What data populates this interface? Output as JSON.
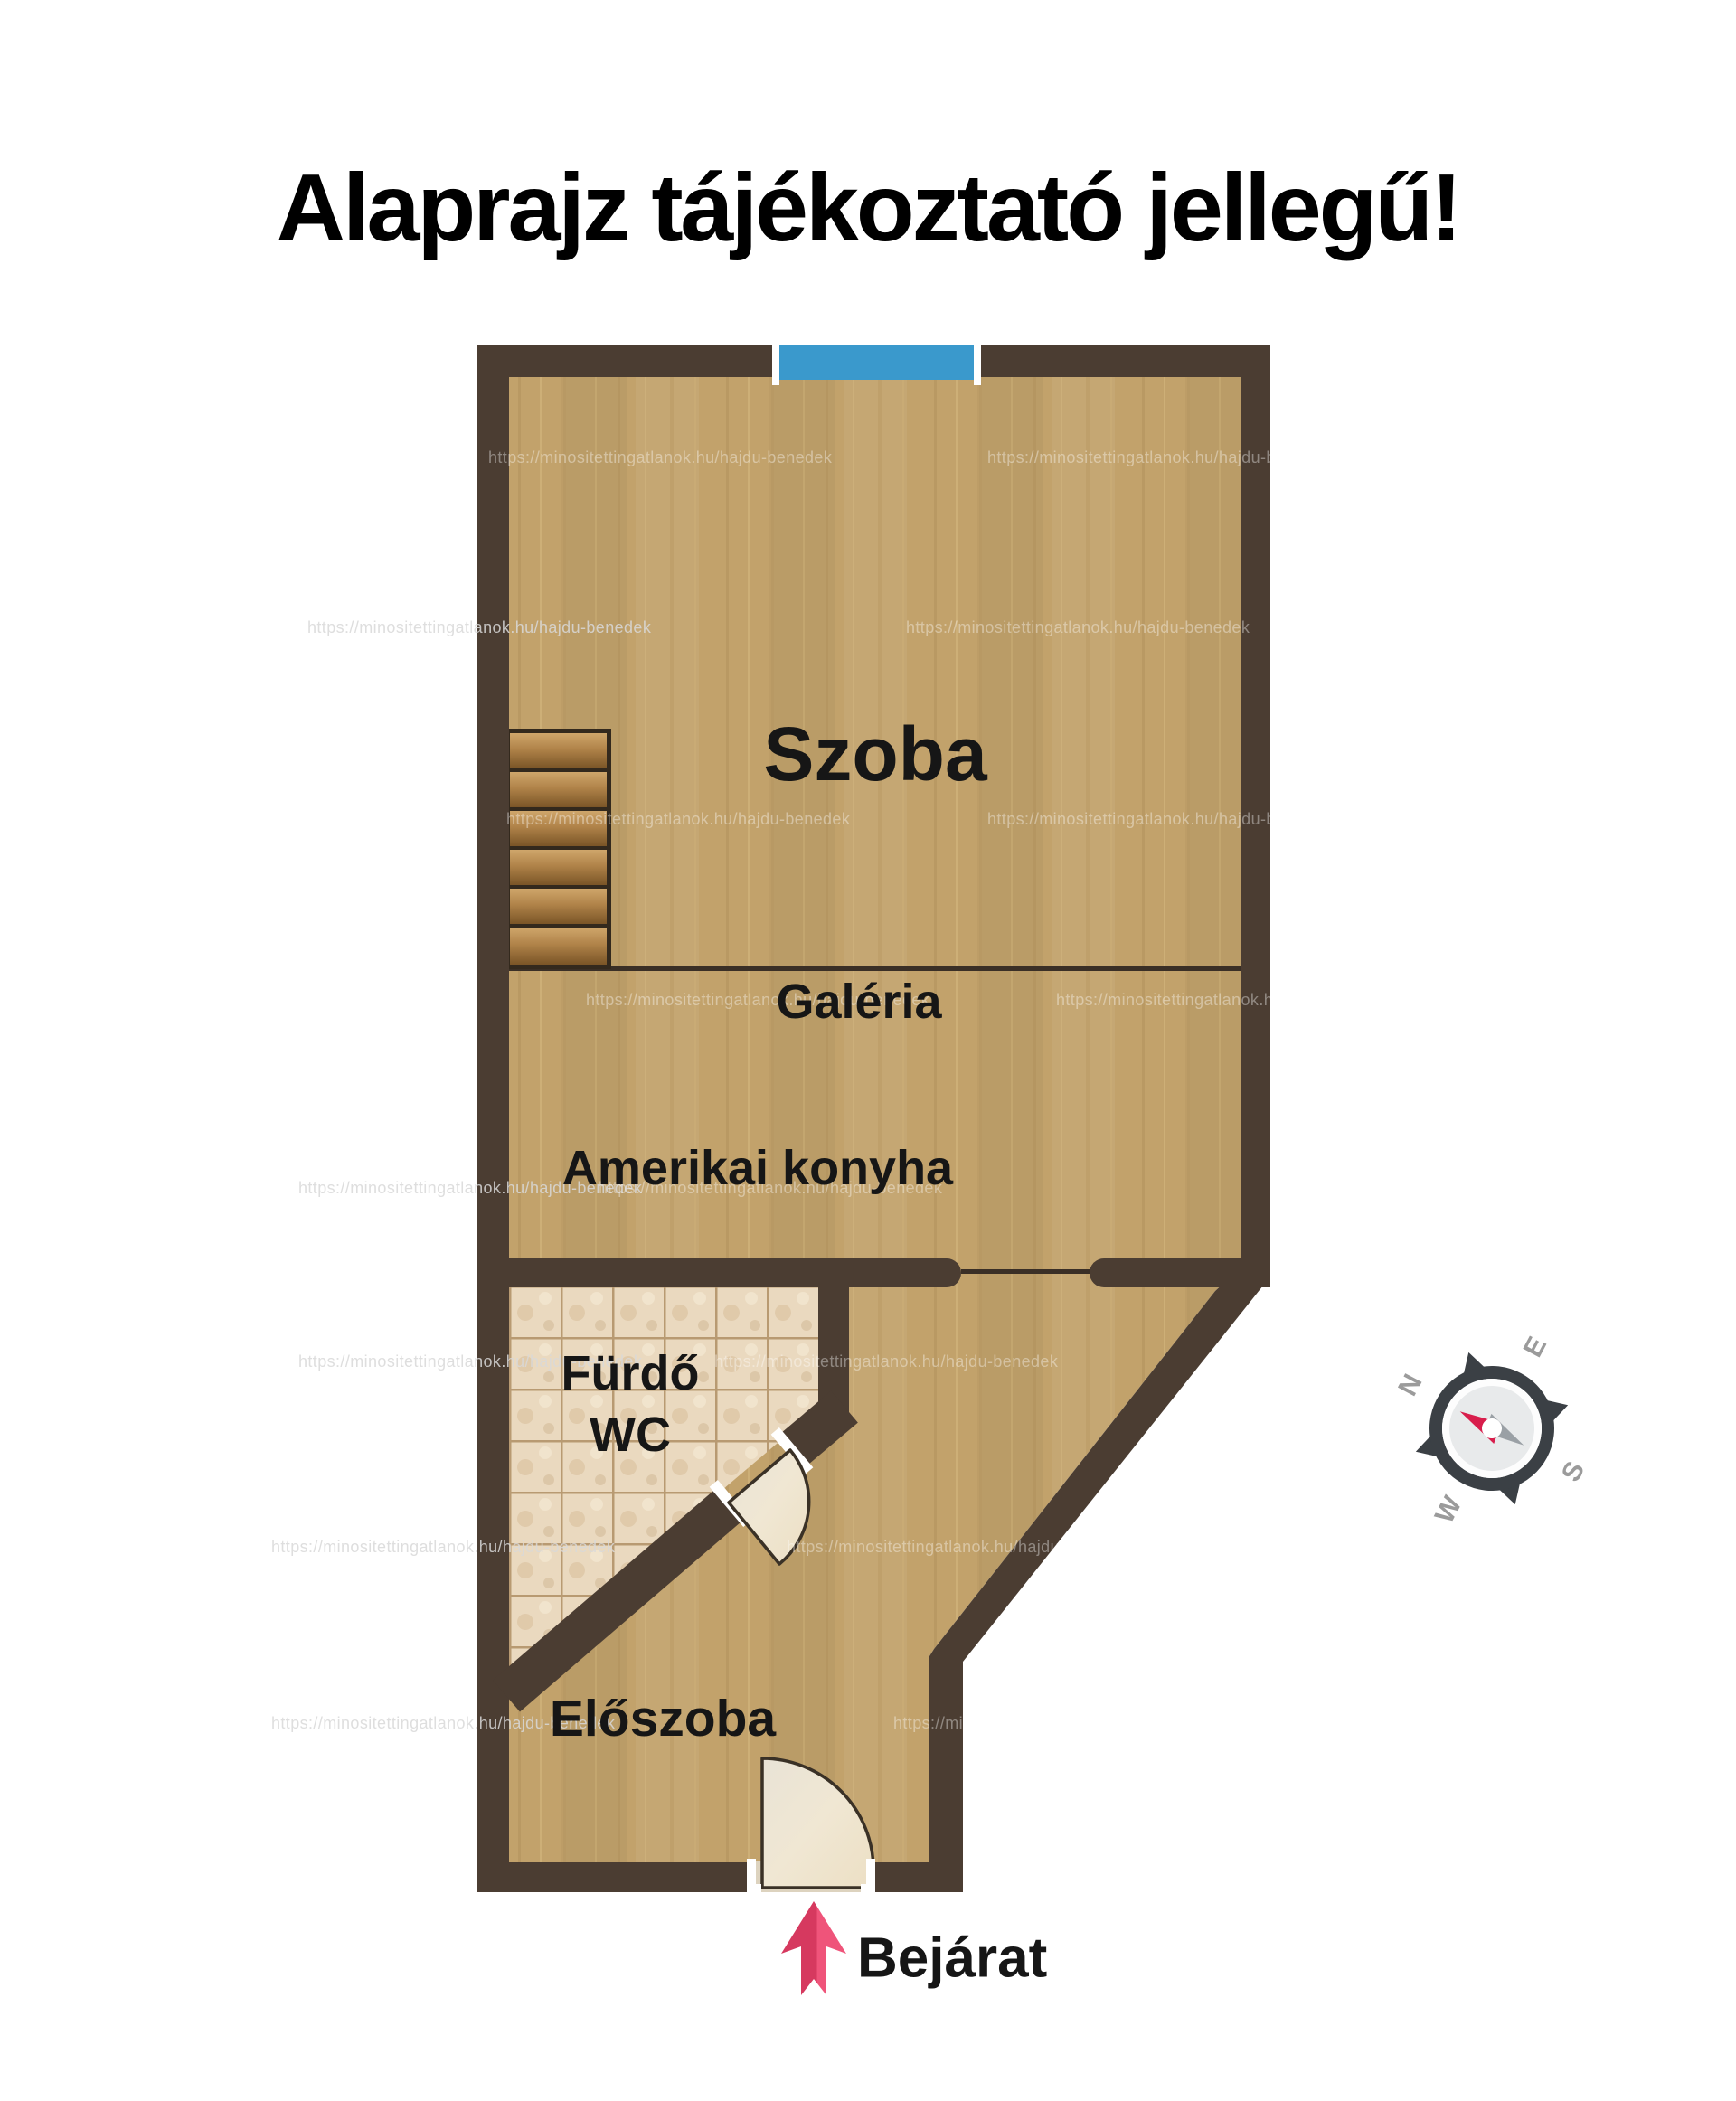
{
  "title": "Alaprajz tájékoztató jellegű!",
  "watermark": {
    "url": "https://minositettingatlanok.hu/hajdu-benedek"
  },
  "rooms": {
    "szoba": "Szoba",
    "galeria": "Galéria",
    "konyha": "Amerikai konyha",
    "furdo": "Fürdő",
    "wc": "WC",
    "eloszoba": "Előszoba"
  },
  "entrance": {
    "label": "Bejárat"
  },
  "compass": {
    "n": "N",
    "e": "E",
    "s": "S",
    "w": "W"
  },
  "colors": {
    "wall": "#4b3d32",
    "floor_wood": "#c2a26b",
    "tile": "#ead9bf",
    "tile_grout": "#b89a72",
    "window_glass": "#3a99cc",
    "door_leaf": "#f0e7d3",
    "entrance_arrow": "#e0416b",
    "compass_needle_north": "#d81e4c",
    "compass_needle_south": "#9aa0a5",
    "label_text": "#161616",
    "title_text": "#000000"
  }
}
